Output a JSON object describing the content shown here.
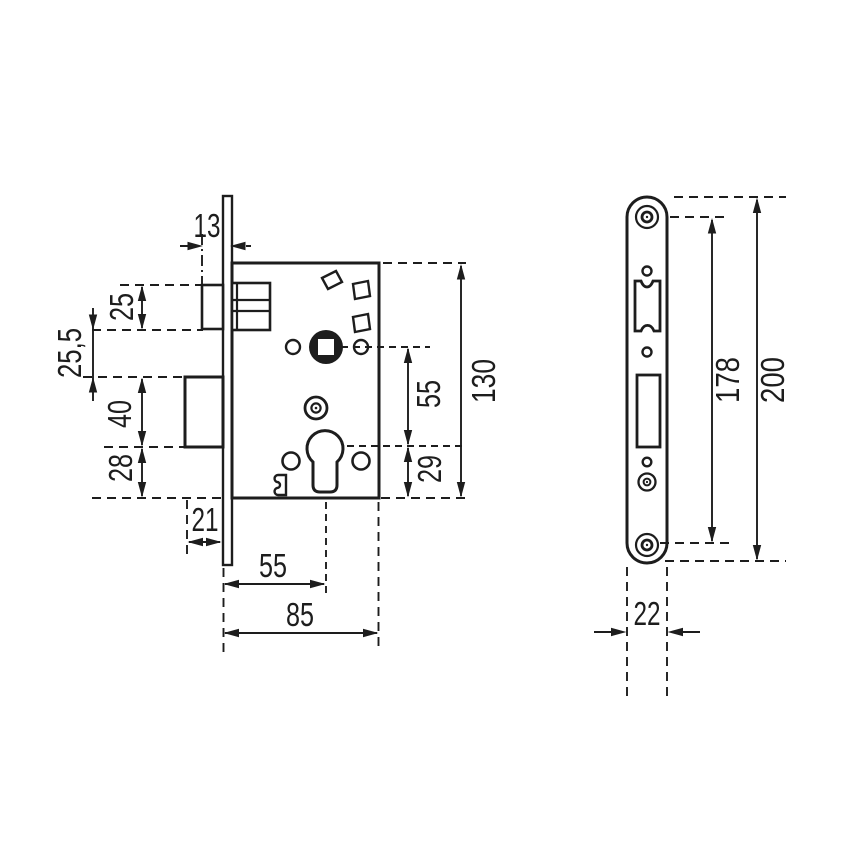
{
  "drawing": {
    "type": "Mortise lock dimensional drawing, side view and faceplate front view",
    "colors": {
      "line": "#1d1d1d",
      "background": "#ffffff"
    },
    "side_view": {
      "labels": {
        "faceplate_offset": "13",
        "latch_height": "25",
        "latch_to_bolt": "25,5",
        "bolt_height": "40",
        "bolt_to_edge": "28",
        "bolt_throw": "21",
        "backset": "55",
        "case_depth": "85",
        "case_height": "130",
        "handle_to_cylinder": "55",
        "cylinder_to_edge": "29"
      }
    },
    "front_view": {
      "labels": {
        "screw_spacing": "178",
        "faceplate_length": "200",
        "faceplate_width": "22"
      }
    }
  }
}
